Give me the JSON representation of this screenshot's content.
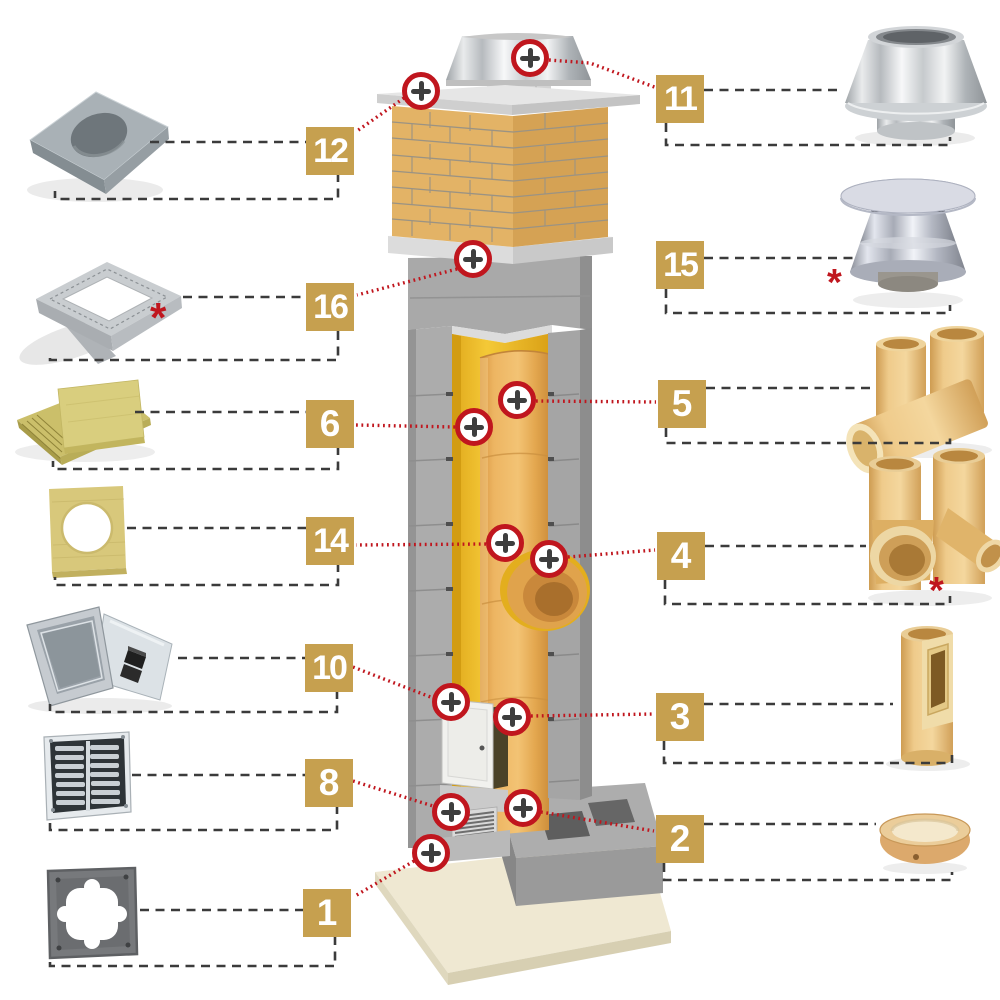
{
  "diagram": {
    "kind": "chimney-system-parts-diagram"
  },
  "palette": {
    "accent_gold": "#C6A04F",
    "marker_red": "#C0161E",
    "dash_gray": "#3B3B3B"
  },
  "marker_glyph": "+",
  "callouts": {
    "left": [
      {
        "number": "12"
      },
      {
        "number": "16",
        "asterisk": "*"
      },
      {
        "number": "6"
      },
      {
        "number": "14"
      },
      {
        "number": "10"
      },
      {
        "number": "8"
      },
      {
        "number": "1"
      }
    ],
    "right": [
      {
        "number": "11"
      },
      {
        "number": "15",
        "asterisk": "*"
      },
      {
        "number": "5"
      },
      {
        "number": "4",
        "asterisk": "*"
      },
      {
        "number": "3"
      },
      {
        "number": "2"
      }
    ]
  }
}
